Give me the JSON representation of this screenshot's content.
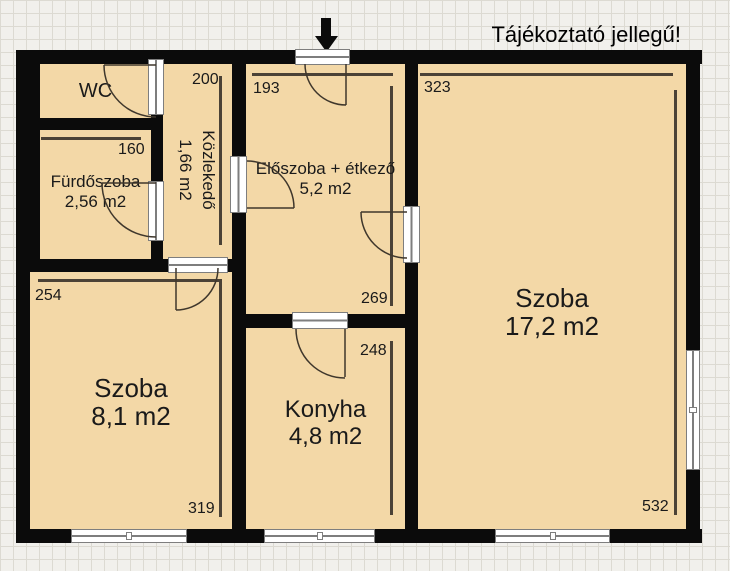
{
  "title": "Tájékoztató jellegű!",
  "rooms": {
    "wc": {
      "name": "WC",
      "area": ""
    },
    "furdoszoba": {
      "name": "Fürdőszoba",
      "area": "2,56 m2"
    },
    "kozlekedo": {
      "name": "Közlekedő",
      "area": "1,66 m2"
    },
    "eloszoba": {
      "name": "Előszoba + étkező",
      "area": "5,2 m2"
    },
    "szoba_nagy": {
      "name": "Szoba",
      "area": "17,2 m2"
    },
    "szoba_kis": {
      "name": "Szoba",
      "area": "8,1 m2"
    },
    "konyha": {
      "name": "Konyha",
      "area": "4,8 m2"
    }
  },
  "dimensions_cm": {
    "eloszoba_width": "193",
    "eloszoba_height": "269",
    "kozlekedo_height": "200",
    "furdoszoba_width": "160",
    "szoba_nagy_width": "323",
    "szoba_nagy_height": "532",
    "szoba_kis_width": "254",
    "szoba_kis_height": "319",
    "konyha_height": "248"
  },
  "icons": {
    "entrance_arrow": "down-arrow"
  },
  "palette": {
    "grid_bg": "#f1f0ec",
    "grid_line": "#dcdad2",
    "room_fill": "#f3d8a7",
    "wall": "#0b0b0b",
    "dim_line": "#4b4236",
    "ink": "#1a1a1a",
    "frame_fill": "#ffffff",
    "frame_border": "#7e7e7e",
    "swing": "#3f372c"
  }
}
